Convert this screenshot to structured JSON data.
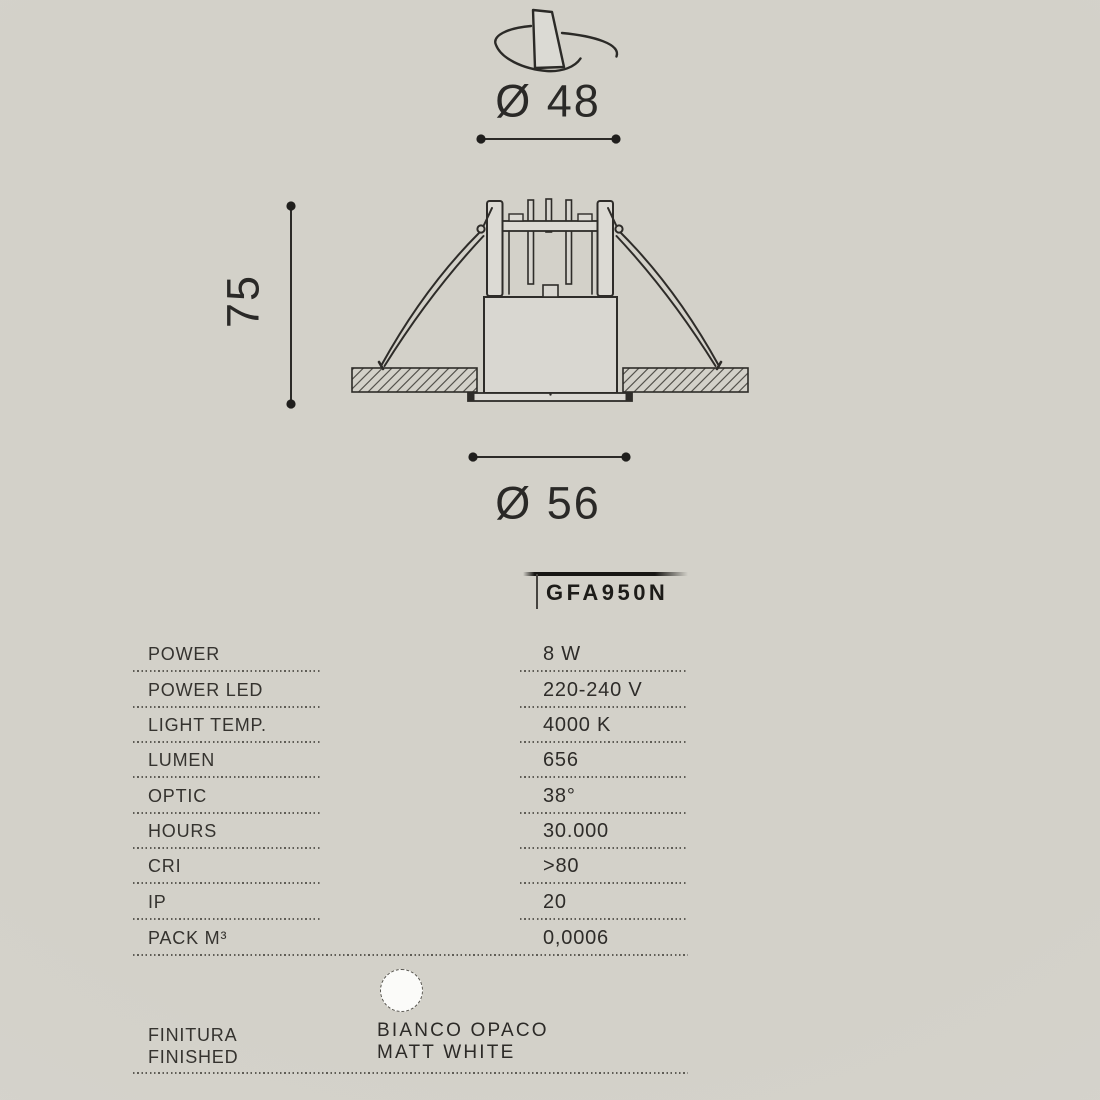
{
  "drawing": {
    "top_diameter_label": "Ø 48",
    "height_label": "75",
    "bottom_diameter_label": "Ø 56"
  },
  "product": {
    "code": "GFA950N"
  },
  "table": {
    "rows": [
      {
        "label": "POWER",
        "value": "8 W"
      },
      {
        "label": "POWER LED",
        "value": "220-240 V"
      },
      {
        "label": "LIGHT TEMP.",
        "value": "4000 K"
      },
      {
        "label": "LUMEN",
        "value": "656"
      },
      {
        "label": "OPTIC",
        "value": "38°"
      },
      {
        "label": "HOURS",
        "value": "30.000"
      },
      {
        "label": "CRI",
        "value": ">80"
      },
      {
        "label": "IP",
        "value": "20"
      },
      {
        "label": "PACK M³",
        "value": "0,0006"
      }
    ]
  },
  "finish": {
    "label_line1": "FINITURA",
    "label_line2": "FINISHED",
    "swatch": "matt-white-color-swatch",
    "swatch_color": "#fbfbf9",
    "value_line1": "BIANCO OPACO",
    "value_line2": "MATT WHITE"
  },
  "colors": {
    "background": "#d4d2cb",
    "line": "#2b2a27",
    "text": "#32302d"
  }
}
